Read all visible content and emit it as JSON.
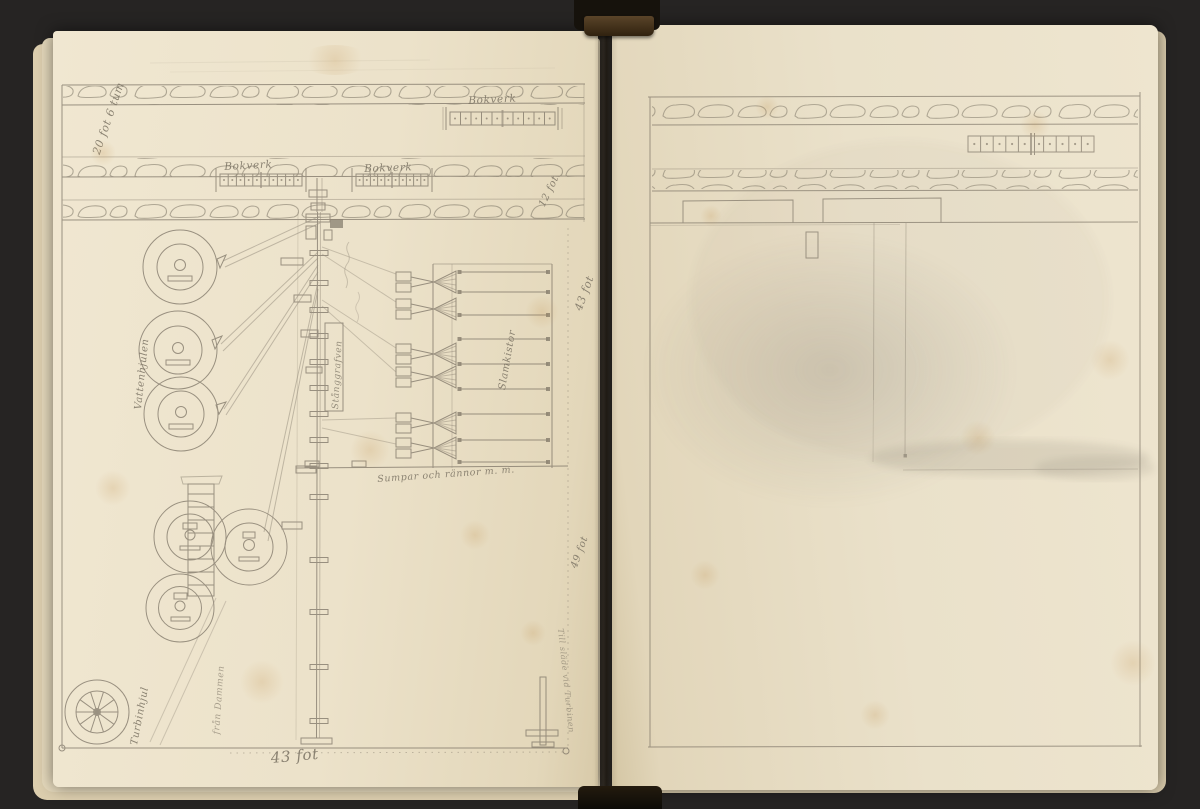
{
  "scene": {
    "background_color": "#262423",
    "page_color": "#ebe1c9",
    "pencil_color": "#7d7466",
    "binding_color": "#16120c",
    "binding_tape_color": "#4e3a26"
  },
  "left_page": {
    "annotations": [
      {
        "id": "dim-20fot6tum",
        "text": "20 fot 6 tum"
      },
      {
        "id": "label-bokverk-top",
        "text": "Bokverk"
      },
      {
        "id": "label-bokverk-mid-left",
        "text": "Bokverk"
      },
      {
        "id": "label-bokverk-mid-right",
        "text": "Bokverk"
      },
      {
        "id": "dim-12fot",
        "text": "12 fot"
      },
      {
        "id": "dim-43fot-right-upper",
        "text": "43 fot"
      },
      {
        "id": "label-vattenhjulen",
        "text": "Vattenhjulen"
      },
      {
        "id": "label-stanggrafven",
        "text": "Stånggrafven"
      },
      {
        "id": "label-slamkistor",
        "text": "Slamkistor"
      },
      {
        "id": "label-sumpar-och-rannor",
        "text": "Sumpar och rännor m. m."
      },
      {
        "id": "label-fran-dammen",
        "text": "från Dammen"
      },
      {
        "id": "label-turbinhjul",
        "text": "Turbinhjul"
      },
      {
        "id": "dim-43fot-bottom",
        "text": "43 fot"
      },
      {
        "id": "dim-49fot-right-lower",
        "text": "49 fot"
      },
      {
        "id": "label-till-slade-vid-turbinen",
        "text": "Till släde vid Turbinen"
      }
    ]
  },
  "right_page": {
    "annotations": []
  }
}
